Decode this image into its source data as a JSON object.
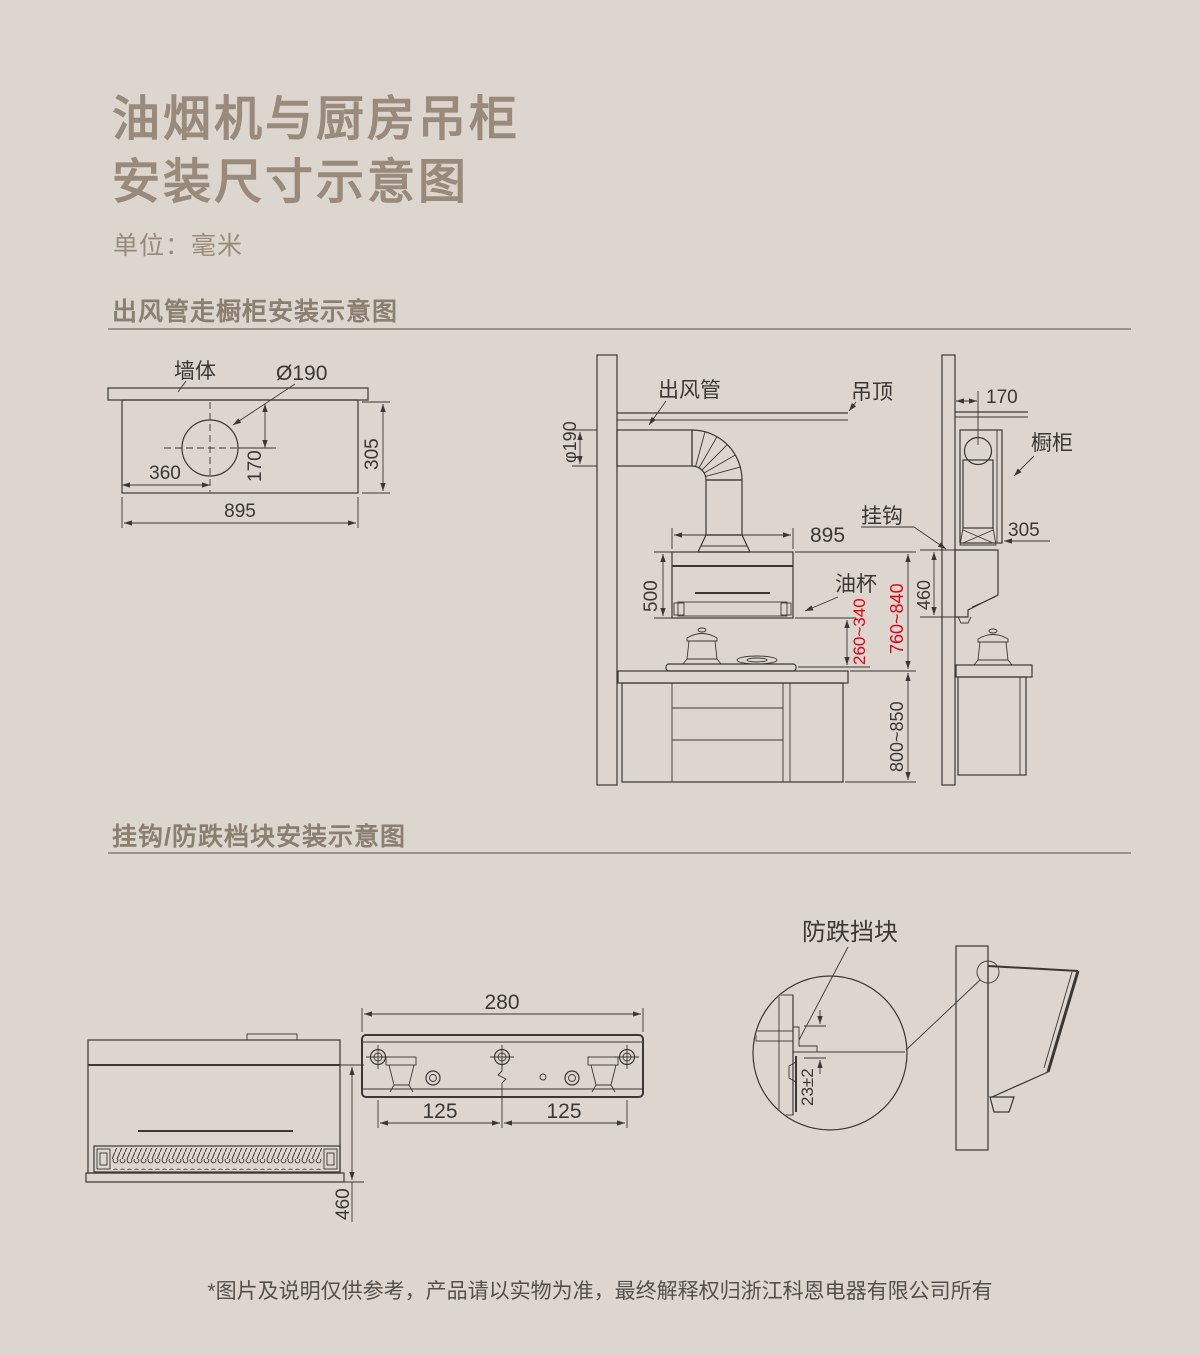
{
  "colors": {
    "background": "#dcd6ce",
    "title": "#9a8a7c",
    "heading": "#8b7f71",
    "line_ink": "#3a3734",
    "dimension_red": "#e60012",
    "rule": "#9c9285",
    "footer": "#53504c"
  },
  "header": {
    "title_line1": "油烟机与厨房吊柜",
    "title_line2": "安装尺寸示意图",
    "unit": "单位：毫米"
  },
  "section1": {
    "heading": "出风管走橱柜安装示意图",
    "top_view": {
      "wall_label": "墙体",
      "hole_dia": "Ø190",
      "dim_360": "360",
      "dim_170": "170",
      "dim_305": "305",
      "dim_895": "895"
    },
    "side_view": {
      "duct_dia": "φ190",
      "duct_label": "出风管",
      "ceiling_label": "吊顶",
      "dim_895": "895",
      "dim_500": "500",
      "oil_cup_label": "油杯",
      "hook_label": "挂钩",
      "dim_260_340": "260~340",
      "dim_760_840": "760~840",
      "dim_800_850": "800~850"
    },
    "cabinet_view": {
      "dim_170": "170",
      "cabinet_label": "橱柜",
      "dim_305": "305",
      "dim_460": "460"
    }
  },
  "section2": {
    "heading": "挂钩/防跌档块安装示意图",
    "front_view": {
      "dim_460": "460"
    },
    "bracket_view": {
      "dim_280": "280",
      "dim_125_left": "125",
      "dim_125_right": "125"
    },
    "detail_view": {
      "block_label": "防跌挡块",
      "dim_23": "23±2"
    }
  },
  "footer": {
    "note": "*图片及说明仅供参考，产品请以实物为准，最终解释权归浙江科恩电器有限公司所有"
  }
}
